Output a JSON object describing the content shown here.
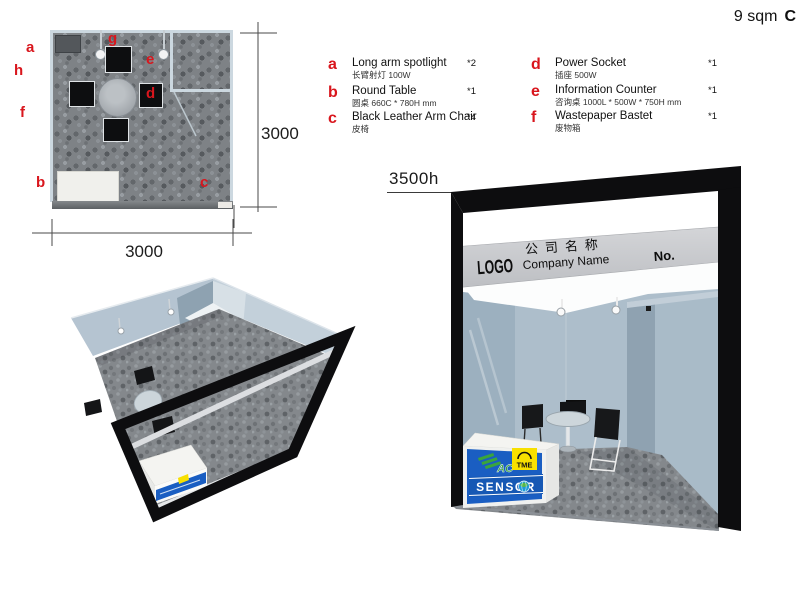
{
  "header": {
    "area_label": "9 sqm",
    "booth_type": "C"
  },
  "floor_plan": {
    "dim_width": "3000",
    "dim_height": "3000",
    "marks": {
      "a": "a",
      "b": "b",
      "c": "c",
      "d": "d",
      "e": "e",
      "f": "f",
      "g": "g",
      "h": "h"
    }
  },
  "legend": {
    "items": [
      {
        "letter": "a",
        "name": "Long arm spotlight",
        "spec": "长臂射灯 100W",
        "qty": "*2"
      },
      {
        "letter": "b",
        "name": "Round Table",
        "spec": "圆桌 660C * 780H mm",
        "qty": "*1"
      },
      {
        "letter": "c",
        "name": "Black Leather Arm Chair",
        "spec": "皮椅",
        "qty": "*4"
      },
      {
        "letter": "d",
        "name": "Power Socket",
        "spec": "插座 500W",
        "qty": "*1"
      },
      {
        "letter": "e",
        "name": "Information Counter",
        "spec": "咨询桌 1000L * 500W * 750H mm",
        "qty": "*1"
      },
      {
        "letter": "f",
        "name": "Wastepaper Bastet",
        "spec": "废物箱",
        "qty": "*1"
      }
    ]
  },
  "front_view": {
    "height_label": "3500h",
    "fascia": {
      "logo_text": "LOGO",
      "company_zh": "公司名称",
      "company_en": "Company Name",
      "booth_no": "No."
    },
    "counter_brands": {
      "ac": "AC",
      "tme": "TME",
      "sensor": "SENSOR"
    }
  },
  "colors": {
    "accent_red": "#d9161d",
    "wall_blue": "#adbecb",
    "fascia_grey": "#c9cbcf",
    "counter_blue": "#1a5ec2",
    "tme_yellow": "#f8e000",
    "ac_green": "#3aa53c",
    "frame_black": "#0d0d0f"
  }
}
